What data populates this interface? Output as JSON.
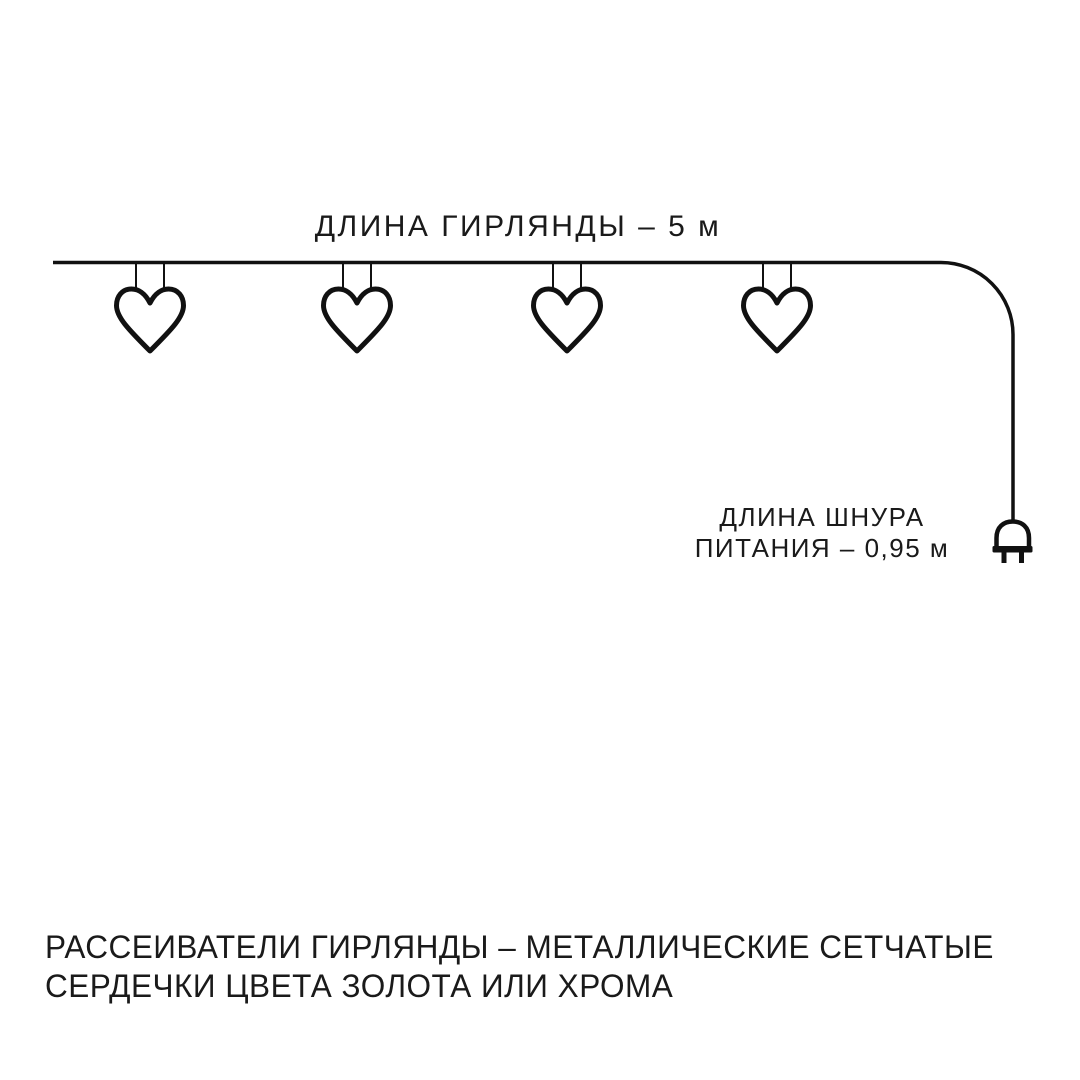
{
  "colors": {
    "background": "#ffffff",
    "line": "#111111",
    "text": "#1a1a1a"
  },
  "diagram": {
    "garland_length_label": "ДЛИНА ГИРЛЯНДЫ – 5 м",
    "cord_length_label_line1": "ДЛИНА ШНУРА",
    "cord_length_label_line2": "ПИТАНИЯ – 0,95 м",
    "heart_count": 4
  },
  "footer": {
    "line1": "РАССЕИВАТЕЛИ ГИРЛЯНДЫ – МЕТАЛЛИЧЕСКИЕ СЕТЧАТЫЕ",
    "line2": "СЕРДЕЧКИ ЦВЕТА ЗОЛОТА ИЛИ ХРОМА"
  }
}
